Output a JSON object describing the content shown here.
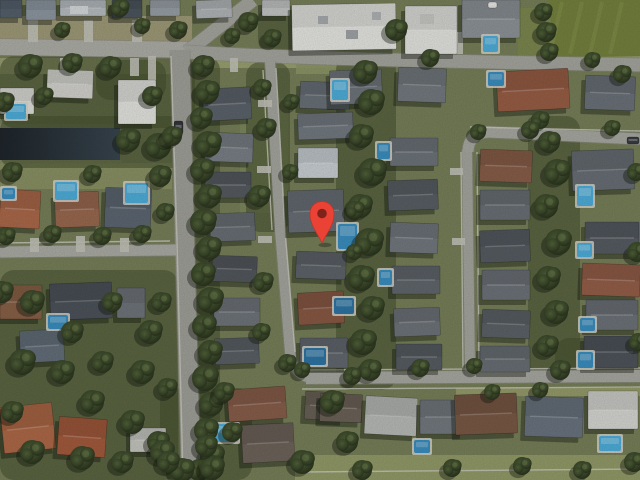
{
  "view": {
    "kind": "satellite-aerial-imagery",
    "description": "Satellite aerial view of a suburban residential neighborhood with a red location marker",
    "width": 640,
    "height": 480,
    "base_color": "#78815a",
    "noise_opacity": 0.22
  },
  "marker": {
    "name": "location-pin",
    "tip_x": 322,
    "tip_y": 243,
    "bulb_y": 213.5,
    "bulb_r": 12,
    "dot_r": 4.8,
    "body_color": "#EA4335",
    "edge_color": "#C0352C",
    "inner_dot_color": "#7E221A"
  },
  "palette": {
    "tree_core": "#54653c",
    "tree_mid": "#3a4729",
    "tree_edge": "#262f1a",
    "tree_highlight": "#6a7c4c",
    "shadow": "#10150e",
    "pool_bright": "#4fb0dd",
    "pool_mid": "#3b90c2",
    "pool_dark": "#2e76a6",
    "pool_deck": "#d8d8cf",
    "driveway": "#c6c6bc",
    "sidewalk": "#cfcfc6",
    "grove": "#46502f"
  },
  "canal": {
    "x": 0,
    "y": 128,
    "w": 120,
    "h": 32,
    "color_from": "#1f262b",
    "color_to": "#394650"
  },
  "field": {
    "points": "548,0 640,0 640,56 556,58",
    "color": "#76833f",
    "stripe_color": "#8a9851"
  },
  "groves": [
    [
      0,
      56,
      195,
      72
    ],
    [
      0,
      116,
      186,
      52
    ],
    [
      0,
      270,
      178,
      210
    ],
    [
      336,
      56,
      60,
      334
    ],
    [
      528,
      116,
      52,
      262
    ],
    [
      192,
      56,
      28,
      424
    ],
    [
      246,
      62,
      44,
      170
    ],
    [
      160,
      388,
      92,
      92
    ],
    [
      555,
      338,
      85,
      42
    ],
    [
      258,
      6,
      52,
      48
    ],
    [
      96,
      60,
      70,
      40
    ]
  ],
  "lawns": [
    [
      0,
      16,
      192,
      26,
      "#a49f7c"
    ],
    [
      0,
      58,
      186,
      16,
      "#9ba173"
    ],
    [
      196,
      56,
      150,
      12,
      "#a0a673"
    ],
    [
      0,
      163,
      172,
      26,
      "#8d9465"
    ],
    [
      295,
      455,
      345,
      25,
      "#97a06b"
    ],
    [
      545,
      56,
      95,
      14,
      "#9aa171"
    ],
    [
      518,
      8,
      42,
      50,
      "#7d8a4f"
    ],
    [
      240,
      98,
      48,
      115,
      "#7e8a5e"
    ],
    [
      0,
      124,
      122,
      4,
      "#8c9070"
    ],
    [
      0,
      160,
      122,
      4,
      "#868c66"
    ],
    [
      456,
      388,
      184,
      8,
      "#9aa06e"
    ],
    [
      296,
      60,
      58,
      14,
      "#8f9868"
    ]
  ],
  "roads": [
    {
      "name": "top-road-west",
      "path": "M 0 47 L 196 50",
      "width": 16,
      "color": "#b0b0a9"
    },
    {
      "name": "north-diagonal-road",
      "path": "M 253 0 L 187 52",
      "width": 13,
      "color": "#a8a8a1"
    },
    {
      "name": "top-road-east",
      "path": "M 186 52 C 320 60 500 62 640 65",
      "width": 13,
      "color": "#a8a8a1"
    },
    {
      "name": "main-road",
      "path": "M 180 50 C 184 160 187 320 191 480",
      "width": 19,
      "color": "#a2a29b"
    },
    {
      "name": "left-side-street",
      "path": "M 0 252 L 176 250",
      "width": 11,
      "color": "#aeaea7"
    },
    {
      "name": "street-a",
      "path": "M 270 62 L 280 230 L 290 352 Q 293 376 312 378",
      "width": 10,
      "color": "#a8a8a1"
    },
    {
      "name": "bottom-street",
      "path": "M 306 378 L 640 376",
      "width": 12,
      "color": "#ababa4"
    },
    {
      "name": "street-b",
      "path": "M 467 150 L 470 374",
      "width": 10,
      "color": "#a8a8a1"
    },
    {
      "name": "street-c",
      "path": "M 468 152 Q 468 134 488 132 L 640 139",
      "width": 11,
      "color": "#ababa4"
    }
  ],
  "sidewalks": [
    "M 276 68 L 285 230 L 295 352",
    "M 263 70 L 272 230",
    "M 461 152 L 463 368",
    "M 477 152 L 479 368",
    "M 300 370 L 640 368",
    "M 302 389 L 640 387",
    "M 470 127 L 640 131",
    "M 171 56 L 177 240 L 183 478",
    "M 0 243 L 170 241",
    "M 300 472 L 640 469"
  ],
  "driveways": [
    [
      28,
      20,
      10,
      22
    ],
    [
      84,
      20,
      9,
      22
    ],
    [
      132,
      20,
      10,
      22
    ],
    [
      60,
      58,
      9,
      18
    ],
    [
      130,
      58,
      9,
      18
    ],
    [
      148,
      56,
      8,
      24
    ],
    [
      230,
      58,
      8,
      14
    ],
    [
      258,
      100,
      14,
      7
    ],
    [
      257,
      166,
      14,
      7
    ],
    [
      258,
      236,
      14,
      7
    ],
    [
      450,
      168,
      13,
      7
    ],
    [
      452,
      238,
      13,
      7
    ],
    [
      30,
      238,
      9,
      14
    ],
    [
      76,
      236,
      9,
      16
    ],
    [
      120,
      238,
      9,
      14
    ],
    [
      405,
      32,
      58,
      22
    ]
  ],
  "buildings": [
    [
      0,
      0,
      22,
      18,
      0,
      "#55616e"
    ],
    [
      26,
      0,
      30,
      20,
      0,
      "#8f99a3"
    ],
    [
      60,
      0,
      46,
      16,
      0,
      "#b9bfc4"
    ],
    [
      112,
      0,
      30,
      18,
      0,
      "#4d565f"
    ],
    [
      150,
      0,
      30,
      16,
      0,
      "#9aa2a8"
    ],
    [
      196,
      0,
      36,
      18,
      -2,
      "#b3b7ba"
    ],
    [
      262,
      0,
      28,
      16,
      0,
      "#c6c8c7"
    ],
    [
      292,
      4,
      104,
      46,
      -1,
      "#e9e9e5"
    ],
    [
      405,
      6,
      52,
      48,
      0,
      "#e7e7e3"
    ],
    [
      462,
      0,
      58,
      38,
      0,
      "#8f959a"
    ],
    [
      0,
      88,
      34,
      26,
      0,
      "#e2e2de"
    ],
    [
      47,
      70,
      46,
      28,
      2,
      "#d6d5d0"
    ],
    [
      118,
      80,
      38,
      44,
      0,
      "#e7e7e3"
    ],
    [
      0,
      190,
      40,
      38,
      3,
      "#ad6a4b"
    ],
    [
      55,
      192,
      44,
      35,
      -2,
      "#9b6a50"
    ],
    [
      105,
      188,
      46,
      40,
      2,
      "#5e6873"
    ],
    [
      50,
      283,
      62,
      36,
      -2,
      "#4e545c"
    ],
    [
      0,
      285,
      42,
      34,
      0,
      "#8a6248"
    ],
    [
      117,
      288,
      28,
      30,
      0,
      "#70767c"
    ],
    [
      20,
      330,
      44,
      32,
      -3,
      "#65707b"
    ],
    [
      2,
      405,
      52,
      46,
      -6,
      "#b06a48"
    ],
    [
      58,
      418,
      48,
      38,
      4,
      "#a55c3e"
    ],
    [
      130,
      428,
      36,
      24,
      0,
      "#c8c8c2"
    ],
    [
      203,
      88,
      48,
      32,
      -3,
      "#5d646c"
    ],
    [
      205,
      133,
      48,
      29,
      2,
      "#7a8187"
    ],
    [
      205,
      172,
      46,
      26,
      0,
      "#575c61"
    ],
    [
      210,
      213,
      45,
      28,
      -2,
      "#6a7076"
    ],
    [
      212,
      256,
      45,
      26,
      2,
      "#54595e"
    ],
    [
      214,
      298,
      46,
      28,
      0,
      "#70767c"
    ],
    [
      215,
      338,
      44,
      26,
      -2,
      "#5b6167"
    ],
    [
      228,
      388,
      58,
      32,
      -4,
      "#8a5f4c"
    ],
    [
      242,
      424,
      52,
      38,
      -3,
      "#6f655c"
    ],
    [
      300,
      82,
      50,
      27,
      2,
      "#6a7279"
    ],
    [
      298,
      113,
      55,
      26,
      -2,
      "#747b82"
    ],
    [
      298,
      148,
      40,
      30,
      0,
      "#ccd2d7"
    ],
    [
      288,
      190,
      56,
      42,
      -2,
      "#697077"
    ],
    [
      296,
      252,
      50,
      27,
      2,
      "#5f656b"
    ],
    [
      298,
      292,
      46,
      32,
      -3,
      "#8a5a45"
    ],
    [
      300,
      338,
      48,
      30,
      0,
      "#636a70"
    ],
    [
      305,
      392,
      40,
      28,
      3,
      "#6a6258"
    ],
    [
      330,
      70,
      52,
      34,
      -2,
      "#6f767c"
    ],
    [
      398,
      68,
      48,
      34,
      2,
      "#757b81"
    ],
    [
      497,
      70,
      72,
      40,
      -3,
      "#9a5f46"
    ],
    [
      585,
      76,
      50,
      34,
      2,
      "#6c737a"
    ],
    [
      390,
      138,
      48,
      28,
      0,
      "#6e757b"
    ],
    [
      388,
      180,
      50,
      30,
      -2,
      "#5a6066"
    ],
    [
      390,
      223,
      48,
      30,
      2,
      "#747a80"
    ],
    [
      392,
      266,
      48,
      28,
      0,
      "#62686e"
    ],
    [
      394,
      308,
      46,
      28,
      -2,
      "#6f757b"
    ],
    [
      396,
      344,
      46,
      26,
      0,
      "#585e64"
    ],
    [
      480,
      150,
      52,
      32,
      2,
      "#8a5f4a"
    ],
    [
      480,
      190,
      50,
      30,
      0,
      "#6b7177"
    ],
    [
      480,
      230,
      50,
      32,
      -2,
      "#575d63"
    ],
    [
      482,
      270,
      48,
      30,
      0,
      "#6e747a"
    ],
    [
      482,
      310,
      48,
      28,
      2,
      "#5d6369"
    ],
    [
      480,
      346,
      50,
      26,
      0,
      "#6a7076"
    ],
    [
      572,
      150,
      62,
      40,
      -2,
      "#6a7077"
    ],
    [
      585,
      222,
      54,
      32,
      0,
      "#575d63"
    ],
    [
      582,
      264,
      58,
      32,
      2,
      "#96604a"
    ],
    [
      586,
      300,
      52,
      30,
      0,
      "#6e747a"
    ],
    [
      584,
      336,
      54,
      32,
      0,
      "#4f555c"
    ],
    [
      320,
      394,
      42,
      28,
      2,
      "#6d6459"
    ],
    [
      365,
      397,
      52,
      38,
      3,
      "#babdb9"
    ],
    [
      420,
      400,
      44,
      34,
      0,
      "#757b81"
    ],
    [
      455,
      394,
      62,
      40,
      -2,
      "#7b5a46"
    ],
    [
      525,
      397,
      58,
      40,
      2,
      "#6b7581"
    ],
    [
      588,
      391,
      50,
      38,
      0,
      "#d9d9d5"
    ]
  ],
  "roof_marks": [
    [
      318,
      16,
      10,
      8,
      "#a9adb0"
    ],
    [
      346,
      30,
      12,
      9,
      "#a2a6a9"
    ],
    [
      372,
      12,
      9,
      8,
      "#b2b5b7"
    ],
    [
      420,
      14,
      14,
      10,
      "#c9c9c5"
    ],
    [
      70,
      6,
      18,
      8,
      "#d8dbdd"
    ]
  ],
  "pools": [
    [
      6,
      104,
      20,
      15,
      "bright"
    ],
    [
      55,
      182,
      22,
      18,
      "bright"
    ],
    [
      125,
      183,
      23,
      20,
      "bright"
    ],
    [
      48,
      315,
      20,
      14,
      "mid"
    ],
    [
      216,
      424,
      22,
      18,
      "bright"
    ],
    [
      332,
      80,
      16,
      20,
      "bright"
    ],
    [
      338,
      224,
      19,
      25,
      "mid"
    ],
    [
      304,
      348,
      22,
      17,
      "dark"
    ],
    [
      377,
      143,
      13,
      16,
      "mid"
    ],
    [
      379,
      270,
      13,
      15,
      "mid"
    ],
    [
      483,
      36,
      15,
      16,
      "bright"
    ],
    [
      577,
      186,
      16,
      20,
      "bright"
    ],
    [
      577,
      243,
      15,
      14,
      "bright"
    ],
    [
      414,
      440,
      16,
      13,
      "mid"
    ],
    [
      599,
      436,
      22,
      15,
      "bright"
    ],
    [
      2,
      188,
      13,
      11,
      "mid"
    ],
    [
      334,
      298,
      20,
      16,
      "dark"
    ],
    [
      488,
      72,
      16,
      14,
      "mid"
    ],
    [
      580,
      318,
      15,
      13,
      "mid"
    ],
    [
      578,
      352,
      15,
      16,
      "mid"
    ]
  ],
  "cars": [
    [
      174,
      121,
      9,
      13,
      "#33363b"
    ],
    [
      627,
      137,
      12,
      7,
      "#3a3d42"
    ],
    [
      488,
      2,
      9,
      6,
      "#e8e8e6"
    ]
  ],
  "trees": [
    [
      203,
      66,
      11
    ],
    [
      207,
      92,
      12
    ],
    [
      201,
      118,
      11
    ],
    [
      208,
      144,
      13
    ],
    [
      202,
      170,
      12
    ],
    [
      209,
      196,
      12
    ],
    [
      203,
      222,
      13
    ],
    [
      209,
      248,
      12
    ],
    [
      203,
      274,
      12
    ],
    [
      210,
      300,
      13
    ],
    [
      204,
      326,
      12
    ],
    [
      210,
      352,
      12
    ],
    [
      205,
      378,
      13
    ],
    [
      211,
      404,
      12
    ],
    [
      206,
      430,
      12
    ],
    [
      212,
      456,
      12
    ],
    [
      199,
      470,
      11
    ],
    [
      165,
      212,
      9
    ],
    [
      161,
      302,
      10
    ],
    [
      167,
      388,
      10
    ],
    [
      158,
      442,
      11
    ],
    [
      262,
      88,
      9
    ],
    [
      266,
      128,
      10
    ],
    [
      259,
      196,
      11
    ],
    [
      263,
      282,
      10
    ],
    [
      261,
      332,
      9
    ],
    [
      287,
      363,
      9
    ],
    [
      291,
      102,
      8
    ],
    [
      290,
      172,
      8
    ],
    [
      365,
      72,
      12
    ],
    [
      371,
      102,
      13
    ],
    [
      361,
      136,
      12
    ],
    [
      372,
      172,
      14
    ],
    [
      360,
      206,
      12
    ],
    [
      369,
      242,
      14
    ],
    [
      361,
      278,
      13
    ],
    [
      372,
      308,
      12
    ],
    [
      363,
      342,
      13
    ],
    [
      370,
      370,
      11
    ],
    [
      549,
      142,
      11
    ],
    [
      557,
      172,
      13
    ],
    [
      546,
      206,
      12
    ],
    [
      558,
      242,
      13
    ],
    [
      548,
      278,
      12
    ],
    [
      556,
      312,
      12
    ],
    [
      547,
      346,
      11
    ],
    [
      560,
      370,
      10
    ],
    [
      540,
      120,
      9
    ],
    [
      30,
      66,
      12
    ],
    [
      72,
      63,
      10
    ],
    [
      110,
      67,
      11
    ],
    [
      4,
      102,
      10
    ],
    [
      44,
      96,
      9
    ],
    [
      152,
      96,
      10
    ],
    [
      12,
      172,
      10
    ],
    [
      92,
      174,
      9
    ],
    [
      160,
      176,
      11
    ],
    [
      6,
      236,
      9
    ],
    [
      52,
      234,
      9
    ],
    [
      102,
      236,
      9
    ],
    [
      142,
      234,
      9
    ],
    [
      2,
      292,
      11
    ],
    [
      32,
      302,
      12
    ],
    [
      72,
      332,
      11
    ],
    [
      112,
      302,
      10
    ],
    [
      150,
      332,
      12
    ],
    [
      22,
      362,
      13
    ],
    [
      62,
      372,
      12
    ],
    [
      102,
      362,
      11
    ],
    [
      142,
      372,
      12
    ],
    [
      12,
      412,
      11
    ],
    [
      92,
      402,
      12
    ],
    [
      132,
      422,
      12
    ],
    [
      32,
      452,
      12
    ],
    [
      82,
      458,
      12
    ],
    [
      122,
      462,
      11
    ],
    [
      162,
      452,
      12
    ],
    [
      128,
      140,
      12
    ],
    [
      158,
      146,
      13
    ],
    [
      172,
      136,
      10
    ],
    [
      248,
      22,
      10
    ],
    [
      272,
      38,
      9
    ],
    [
      232,
      36,
      8
    ],
    [
      543,
      12,
      9
    ],
    [
      546,
      32,
      10
    ],
    [
      549,
      52,
      9
    ],
    [
      592,
      60,
      8
    ],
    [
      622,
      74,
      9
    ],
    [
      478,
      132,
      8
    ],
    [
      530,
      130,
      9
    ],
    [
      612,
      128,
      8
    ],
    [
      636,
      172,
      9
    ],
    [
      637,
      252,
      10
    ],
    [
      638,
      342,
      9
    ],
    [
      474,
      366,
      8
    ],
    [
      420,
      368,
      9
    ],
    [
      352,
      376,
      9
    ],
    [
      302,
      370,
      8
    ],
    [
      332,
      402,
      12
    ],
    [
      347,
      442,
      11
    ],
    [
      302,
      462,
      12
    ],
    [
      362,
      470,
      10
    ],
    [
      452,
      468,
      9
    ],
    [
      522,
      466,
      9
    ],
    [
      582,
      470,
      9
    ],
    [
      634,
      462,
      10
    ],
    [
      492,
      392,
      8
    ],
    [
      540,
      390,
      8
    ],
    [
      182,
      470,
      12
    ],
    [
      212,
      468,
      12
    ],
    [
      232,
      432,
      10
    ],
    [
      224,
      392,
      10
    ],
    [
      206,
      446,
      11
    ],
    [
      168,
      462,
      11
    ],
    [
      120,
      8,
      9
    ],
    [
      142,
      26,
      8
    ],
    [
      178,
      30,
      9
    ],
    [
      62,
      30,
      8
    ],
    [
      355,
      210,
      9
    ],
    [
      354,
      252,
      8
    ],
    [
      396,
      30,
      11
    ],
    [
      430,
      58,
      9
    ]
  ]
}
